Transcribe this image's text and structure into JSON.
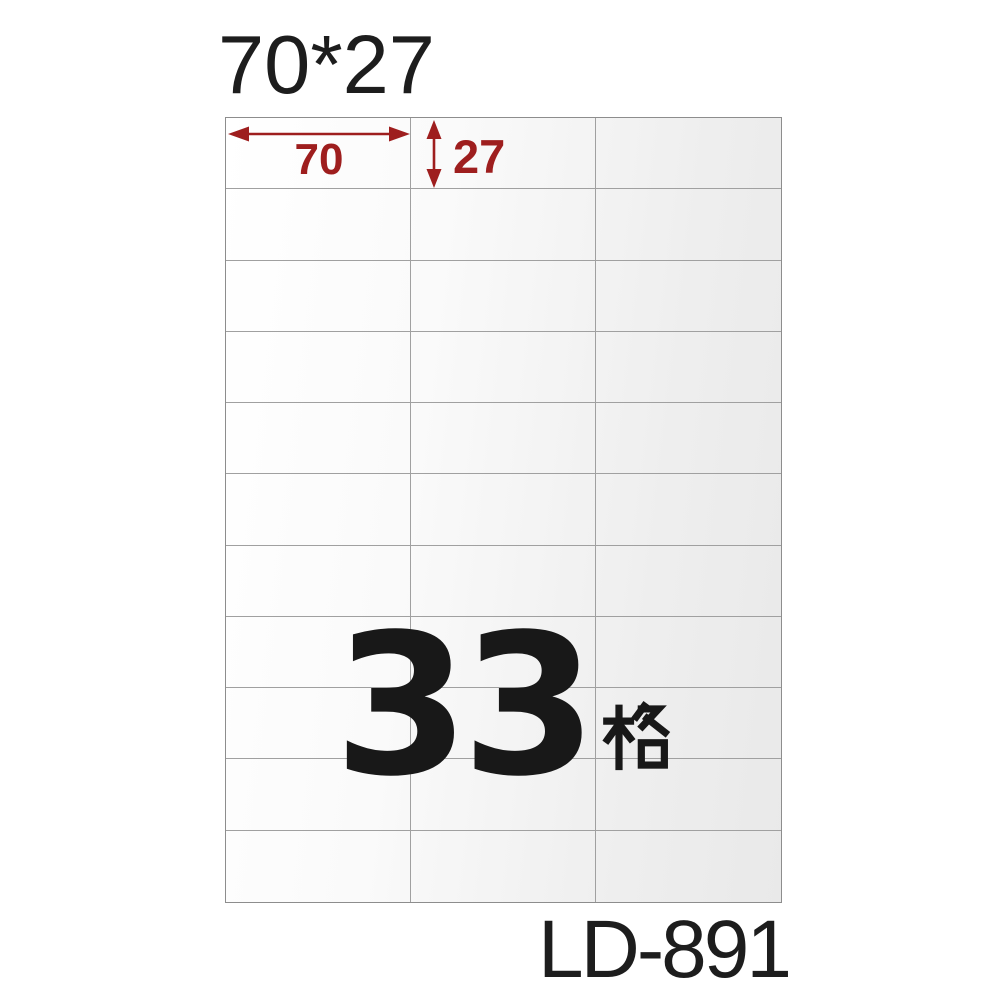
{
  "header": {
    "size_text": "70*27"
  },
  "dimensions": {
    "width_label": "70",
    "height_label": "27",
    "unit_note": ""
  },
  "count": {
    "number": "33",
    "unit": "格"
  },
  "footer": {
    "product_code": "LD-891"
  },
  "grid": {
    "columns": 3,
    "rows": 11,
    "total_cells": 33
  },
  "colors": {
    "dimension_red": "#9E1E1E",
    "text_dark": "#1D1D1D",
    "count_black": "#181818",
    "grid_line": "#A0A0A0",
    "sheet_border": "#8D8D8D",
    "sheet_gradient_start": "#FFFFFF",
    "sheet_gradient_end": "#E9E9E9",
    "page_background": "#FFFFFF"
  }
}
